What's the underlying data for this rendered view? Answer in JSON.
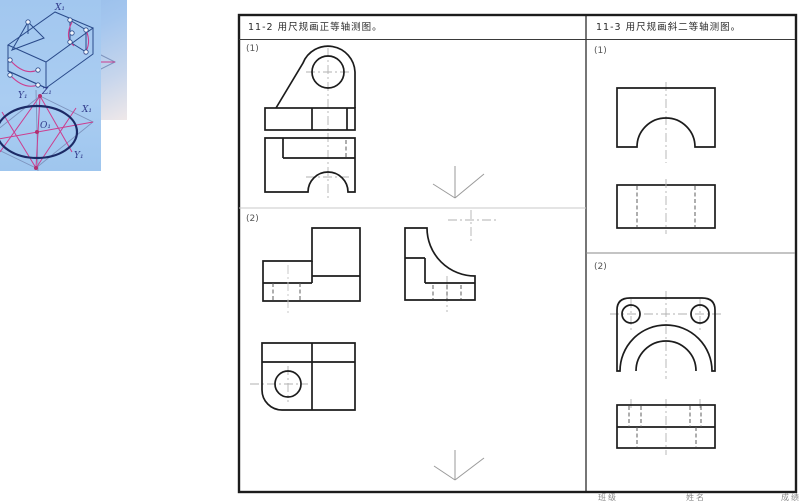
{
  "figures": {
    "ellipse_construction": {
      "point_labels": [
        "E₁",
        "B₁",
        "A₁",
        "E₄"
      ],
      "distance_labels": [
        "d",
        "d"
      ]
    },
    "box_construction": {
      "box_labels": [
        "X₁",
        "Y₁"
      ],
      "ellipse_labels": [
        "Z₁",
        "X₁",
        "O₁",
        "Y₁"
      ]
    }
  },
  "worksheet": {
    "left_panel": {
      "title": "11-2 用尺规画正等轴测图。",
      "problems": [
        {
          "label": "(1)"
        },
        {
          "label": "(2)"
        }
      ]
    },
    "right_panel": {
      "title": "11-3 用尺规画斜二等轴测图。",
      "problems": [
        {
          "label": "(1)"
        },
        {
          "label": "(2)"
        }
      ]
    },
    "footer": {
      "class_field": "班级",
      "name_field": "姓名",
      "score_field": "成绩"
    }
  },
  "colors": {
    "sheet_line": "#1c1c1c",
    "centerline": "#b2b2b2",
    "hidden_line": "#5e5e5e",
    "construction_pink": "#cc3d8f",
    "figure_navy": "#1c2a66",
    "figure_bg_blue": "#a6c9ef",
    "axis_symbol_gray": "#9a9a9a"
  }
}
